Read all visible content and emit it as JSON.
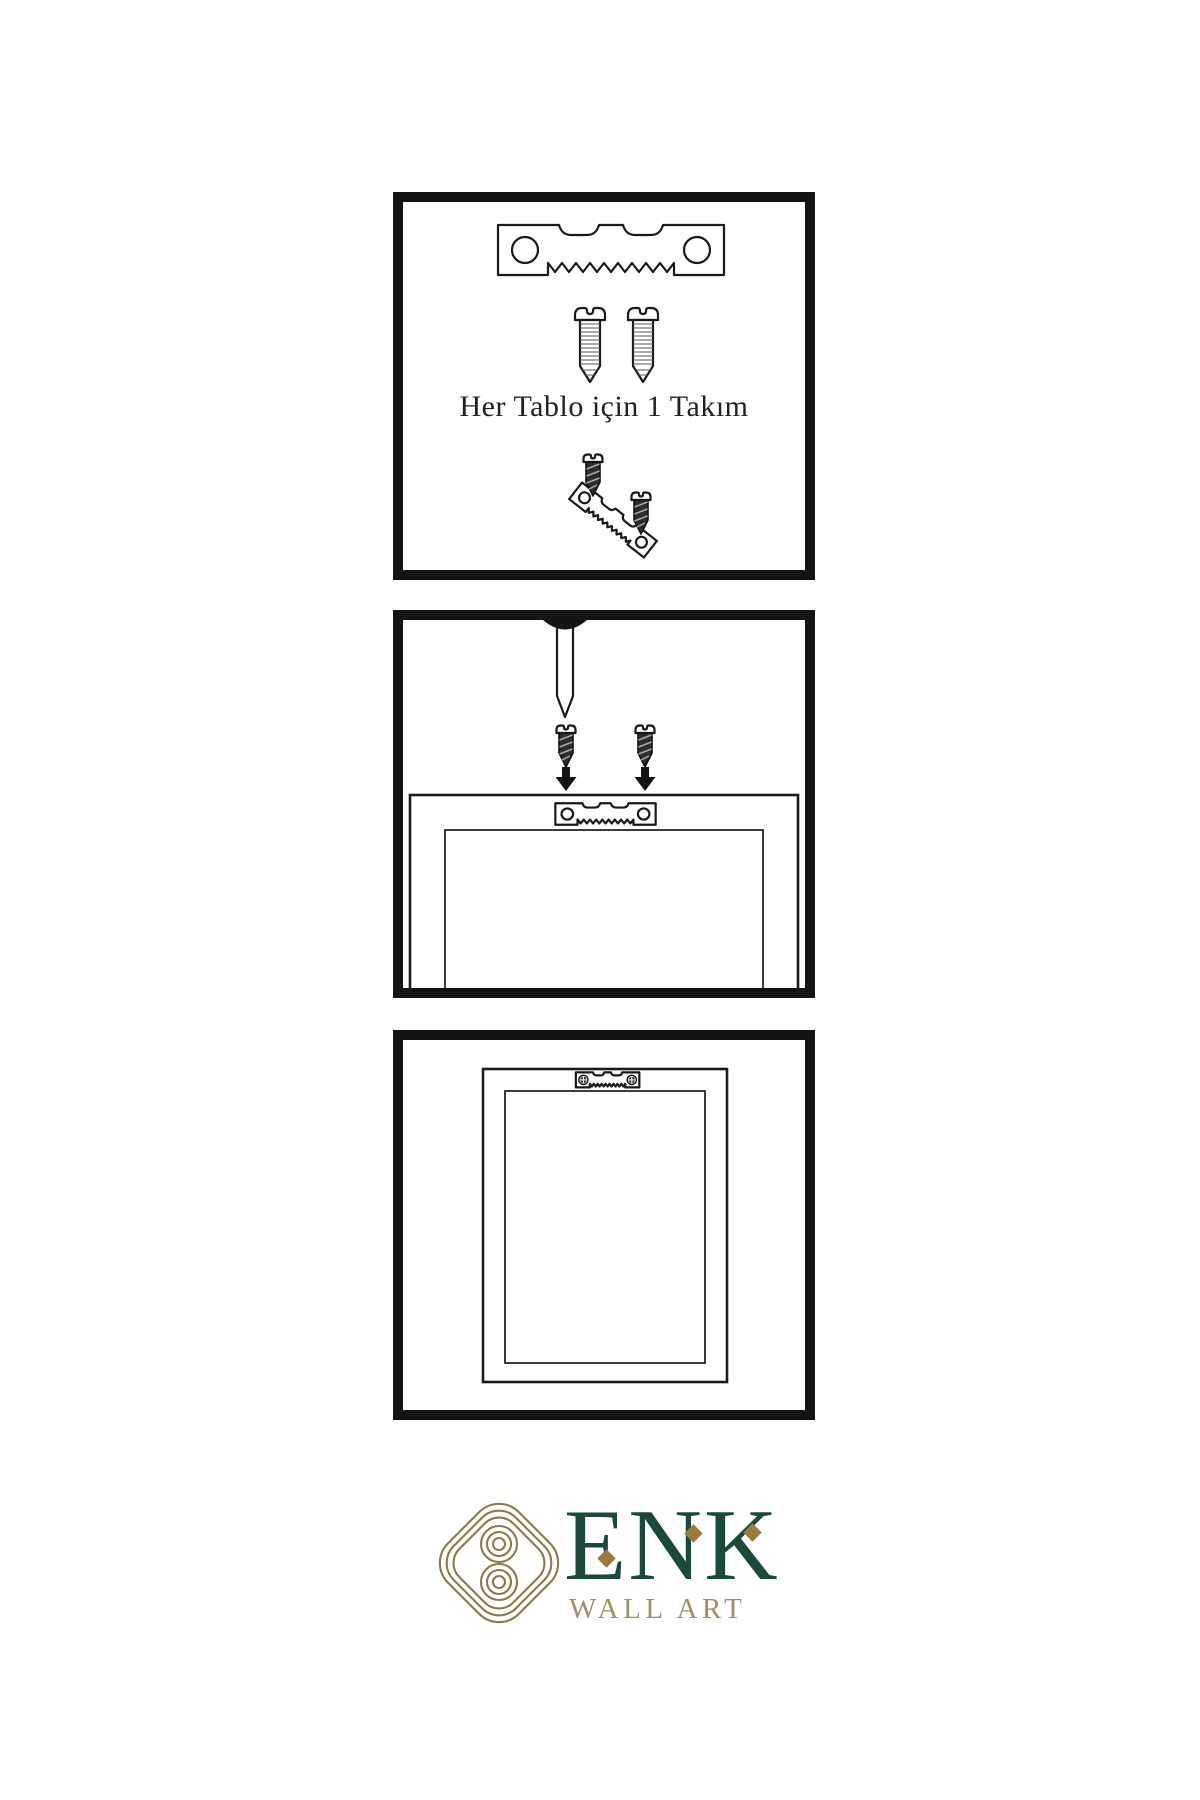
{
  "page": {
    "background": "#ffffff"
  },
  "steps": [
    {
      "id": 1,
      "caption": "Her Tablo için 1 Takım",
      "items": [
        "sawtooth-hanger",
        "screw",
        "screw",
        "screws-driven-into-hanger"
      ]
    },
    {
      "id": 2,
      "items": [
        "wall-nail",
        "screw",
        "screw",
        "down-arrow",
        "down-arrow",
        "frame-back-with-sawtooth-hanger"
      ]
    },
    {
      "id": 3,
      "items": [
        "hung-frame-with-mounted-hanger"
      ]
    }
  ],
  "logo": {
    "brand": "ENK",
    "subtitle": "WALL ART"
  },
  "colors": {
    "line_art": "#1a1a1a",
    "panel_border": "#141414",
    "logo_knot_gold": "#8a7a4a",
    "logo_brand_green": "#1a4a3c",
    "logo_diamond_gold": "#9c7b3a",
    "logo_subtitle_tan": "#a28f66"
  }
}
